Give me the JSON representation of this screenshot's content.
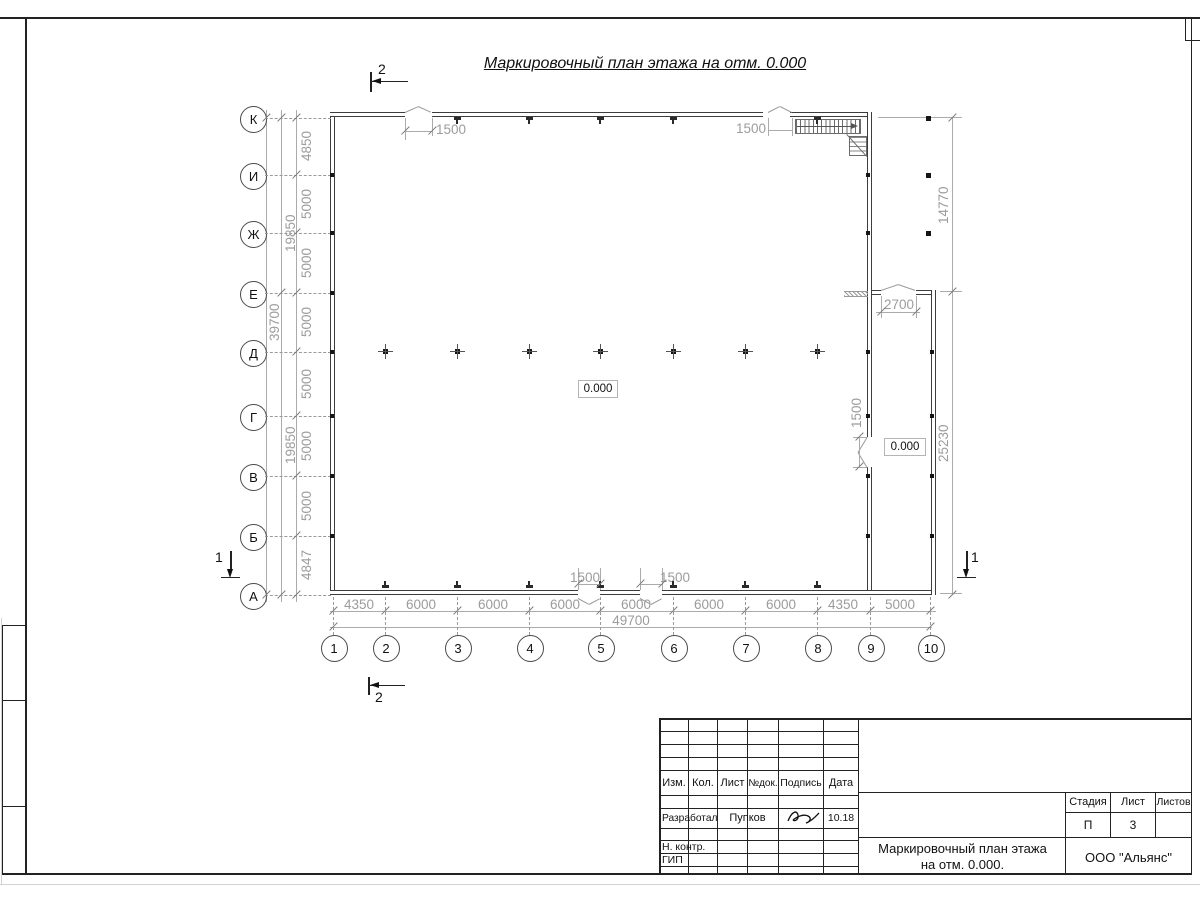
{
  "sheet": {
    "title": "Маркировочный план этажа на отм. 0.000"
  },
  "plan": {
    "row_axes": [
      "К",
      "И",
      "Ж",
      "Е",
      "Д",
      "Г",
      "В",
      "Б",
      "А"
    ],
    "col_axes": [
      "1",
      "2",
      "3",
      "4",
      "5",
      "6",
      "7",
      "8",
      "9",
      "10"
    ],
    "left_dims": [
      "4850",
      "5000",
      "5000",
      "5000",
      "5000",
      "5000",
      "5000",
      "4847"
    ],
    "left_subtotals": [
      "19850",
      "19850"
    ],
    "left_total": "39700",
    "bottom_dims": [
      "4350",
      "6000",
      "6000",
      "6000",
      "6000",
      "6000",
      "6000",
      "4350",
      "5000"
    ],
    "bottom_total": "49700",
    "right_dims": [
      "14770",
      "25230"
    ],
    "openings": {
      "top_left": "1500",
      "top_right": "1500",
      "bottom_left": "1500",
      "bottom_right": "1500",
      "annex_top": "2700",
      "annex_side": "1500"
    },
    "elevations": {
      "main": "0.000",
      "annex": "0.000"
    },
    "sections": {
      "top": "2",
      "bottom": "2",
      "left": "1",
      "right": "1"
    }
  },
  "title_block": {
    "columns": [
      "Изм.",
      "Кол.",
      "Лист",
      "№док.",
      "Подпись",
      "Дата"
    ],
    "developer_label": "Разработал",
    "developer_name": "Пупков",
    "date": "10.18",
    "ncontrol_label": "Н. контр.",
    "gip_label": "ГИП",
    "stage_label": "Стадия",
    "sheet_label": "Лист",
    "sheets_label": "Листов",
    "stage_value": "П",
    "sheet_value": "3",
    "doc_title_line1": "Маркировочный план этажа",
    "doc_title_line2": "на отм. 0.000.",
    "company": "ООО \"Альянс\""
  }
}
